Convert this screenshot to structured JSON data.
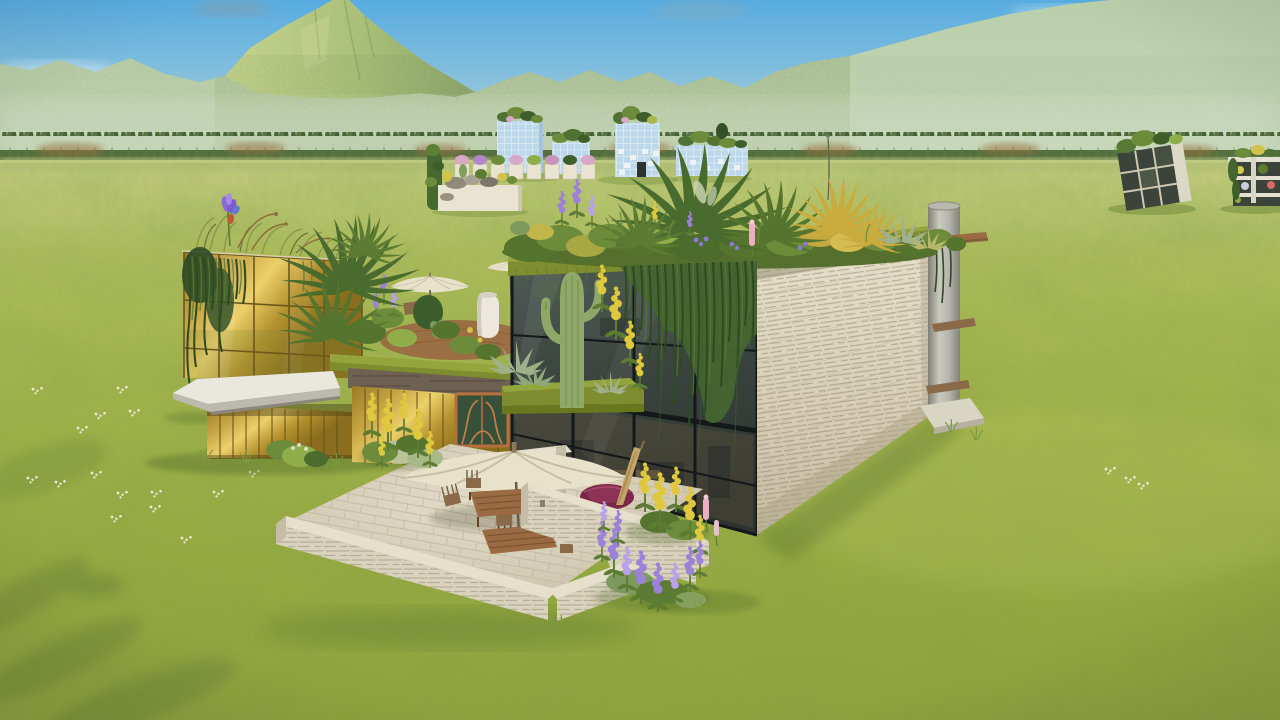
{
  "app": {
    "name": "3d-sandbox-game-viewport",
    "hud_visible": false,
    "visible_text": ""
  },
  "scene": {
    "environment": {
      "sky": "clear blue sky with thin white clouds and a small grey wisp",
      "terrain": "vast flat yellow-green meadow with scattered white daisies",
      "background": "hazy forested mountain range with a tall peak left of center rising off the right edge",
      "treeline": "dense conifer band with autumn-orange patches at the foot of the mountains"
    },
    "main_building": {
      "type": "modern two-storey eco villa",
      "features": [
        "rooftop garden with large ferns, purple lupines, pink flower spike, golden shrubs and agaves",
        "bronze mirrored-glass tower with rooftop grasses and a purple iris",
        "hanging ivy curtains over glass and stacked-stone walls",
        "dark glazed curtain-wall facade with black mullions",
        "white cantilevered canopy slab",
        "cream stacked-stone side wall",
        "concrete chimney cylinder with wooden shelves and concrete base slab",
        "copper ornamental entry door",
        "roof terrace with two cream parasols, white lantern and wooden deck",
        "saguaro cactus on a mossy planter ledge with yellow flower spikes"
      ]
    },
    "patio": [
      "stone paved terrace",
      "large cream parasol",
      "wooden dining table with four chairs",
      "wooden lounger and stool",
      "stone fireplace block with dark niche",
      "low stacked-stone perimeter walls",
      "maroon round daybed behind tall wall",
      "folded tan parasol leaning"
    ],
    "flowers": [
      "yellow lupines left of patio",
      "yellow lupines right of patio",
      "purple lupine bed",
      "pink flower spikes",
      "white daisies in grass"
    ],
    "distant_buildings": [
      "row of light-blue glass cube buildings with rooftop plants",
      "row of small white planters with pink and purple blooms",
      "white stone planter box with rocks and yellow flowers",
      "green vine column",
      "leaning dark-panel building with white concrete slab and green roof",
      "open shelf structure with colorful items at right edge"
    ]
  },
  "palette": {
    "sky_top": "#57ACE0",
    "sky_mid": "#82BEDD",
    "sky_low": "#AACDD6",
    "sky_horizon": "#CEDCCA",
    "mtn_top": "#A7C093",
    "mtn_bottom": "#C2D2AE",
    "peak_lit": "#C4D38C",
    "peak_mid": "#A9BF78",
    "peak_shade": "#8CA66A",
    "tree_dark": "#4D6638",
    "tree_mid": "#5A7342",
    "tree_base": "#55703F",
    "tree_autumn": "#97713F",
    "grass_0": "#C8D187",
    "grass_1": "#B2C060",
    "grass_2": "#A3B44B",
    "grass_3": "#97AA40",
    "grass_4": "#8EA23C",
    "grass_shadow": "#4F6A28",
    "gold_0": "#9A7A24",
    "gold_1": "#C8A645",
    "gold_2": "#ECD06A",
    "gold_3": "#B5922F",
    "gold_4": "#8A6D1E",
    "gold_mullion": "#6B571A",
    "glass_0": "#4D5954",
    "glass_1": "#3C4540",
    "glass_2": "#2C3430",
    "mullion": "#14181A",
    "stone_0": "#E8E1CB",
    "stone_1": "#D6CDB4",
    "stone_2": "#C4BBA1",
    "wall_top": "#E5DFCC",
    "wall_face": "#D9D2BC",
    "patio_0": "#E2DBC8",
    "patio_1": "#C8C0A8",
    "cyl_0": "#7E7E74",
    "cyl_1": "#C9C9BF",
    "cyl_2": "#B5B5AB",
    "cyl_3": "#82827A",
    "concrete": "#D9D5C5",
    "canopy": "#E9E7DE",
    "canopy_edge": "#BCB9AE",
    "moss": "#7D8D2F",
    "moss_light": "#95A53D",
    "fol_dark": "#3F5F2A",
    "fol_mid": "#6D8C3B",
    "fol_light": "#8FAE4A",
    "vine": "#44652F",
    "vine_dark": "#2F4A22",
    "vine_light": "#567A36",
    "fern_1": "#4A6B2E",
    "fern_2": "#55742E",
    "fern_3": "#5D7C33",
    "golden_frond": "#C9AB3E",
    "cactus": "#8FA868",
    "cactus_rib": "#6F8A4E",
    "agave": "#9FB08A",
    "flower_purple": "#9B82D8",
    "flower_purple_light": "#B8A2E8",
    "flower_yellow": "#DDC83E",
    "flower_pink": "#E8B0C0",
    "iris_purple": "#8A6AD4",
    "iris_accent": "#C05838",
    "umbrella_cream": "#E9E2CB",
    "umbrella_tan": "#C4A468",
    "wood": "#9A6B42",
    "wood_dark": "#7D5430",
    "chair": "#8A6A48",
    "daybed": "#7A2848",
    "daybed_light": "#8F3356",
    "door_copper": "#B5703C",
    "door_glass": "#36503A",
    "distant_glass": "#BDD8EA",
    "distant_white": "#E9E3D1",
    "dark_panel": "#3B433A",
    "slab_white": "#E4E0D2",
    "daisy": "#F4F2E2"
  }
}
